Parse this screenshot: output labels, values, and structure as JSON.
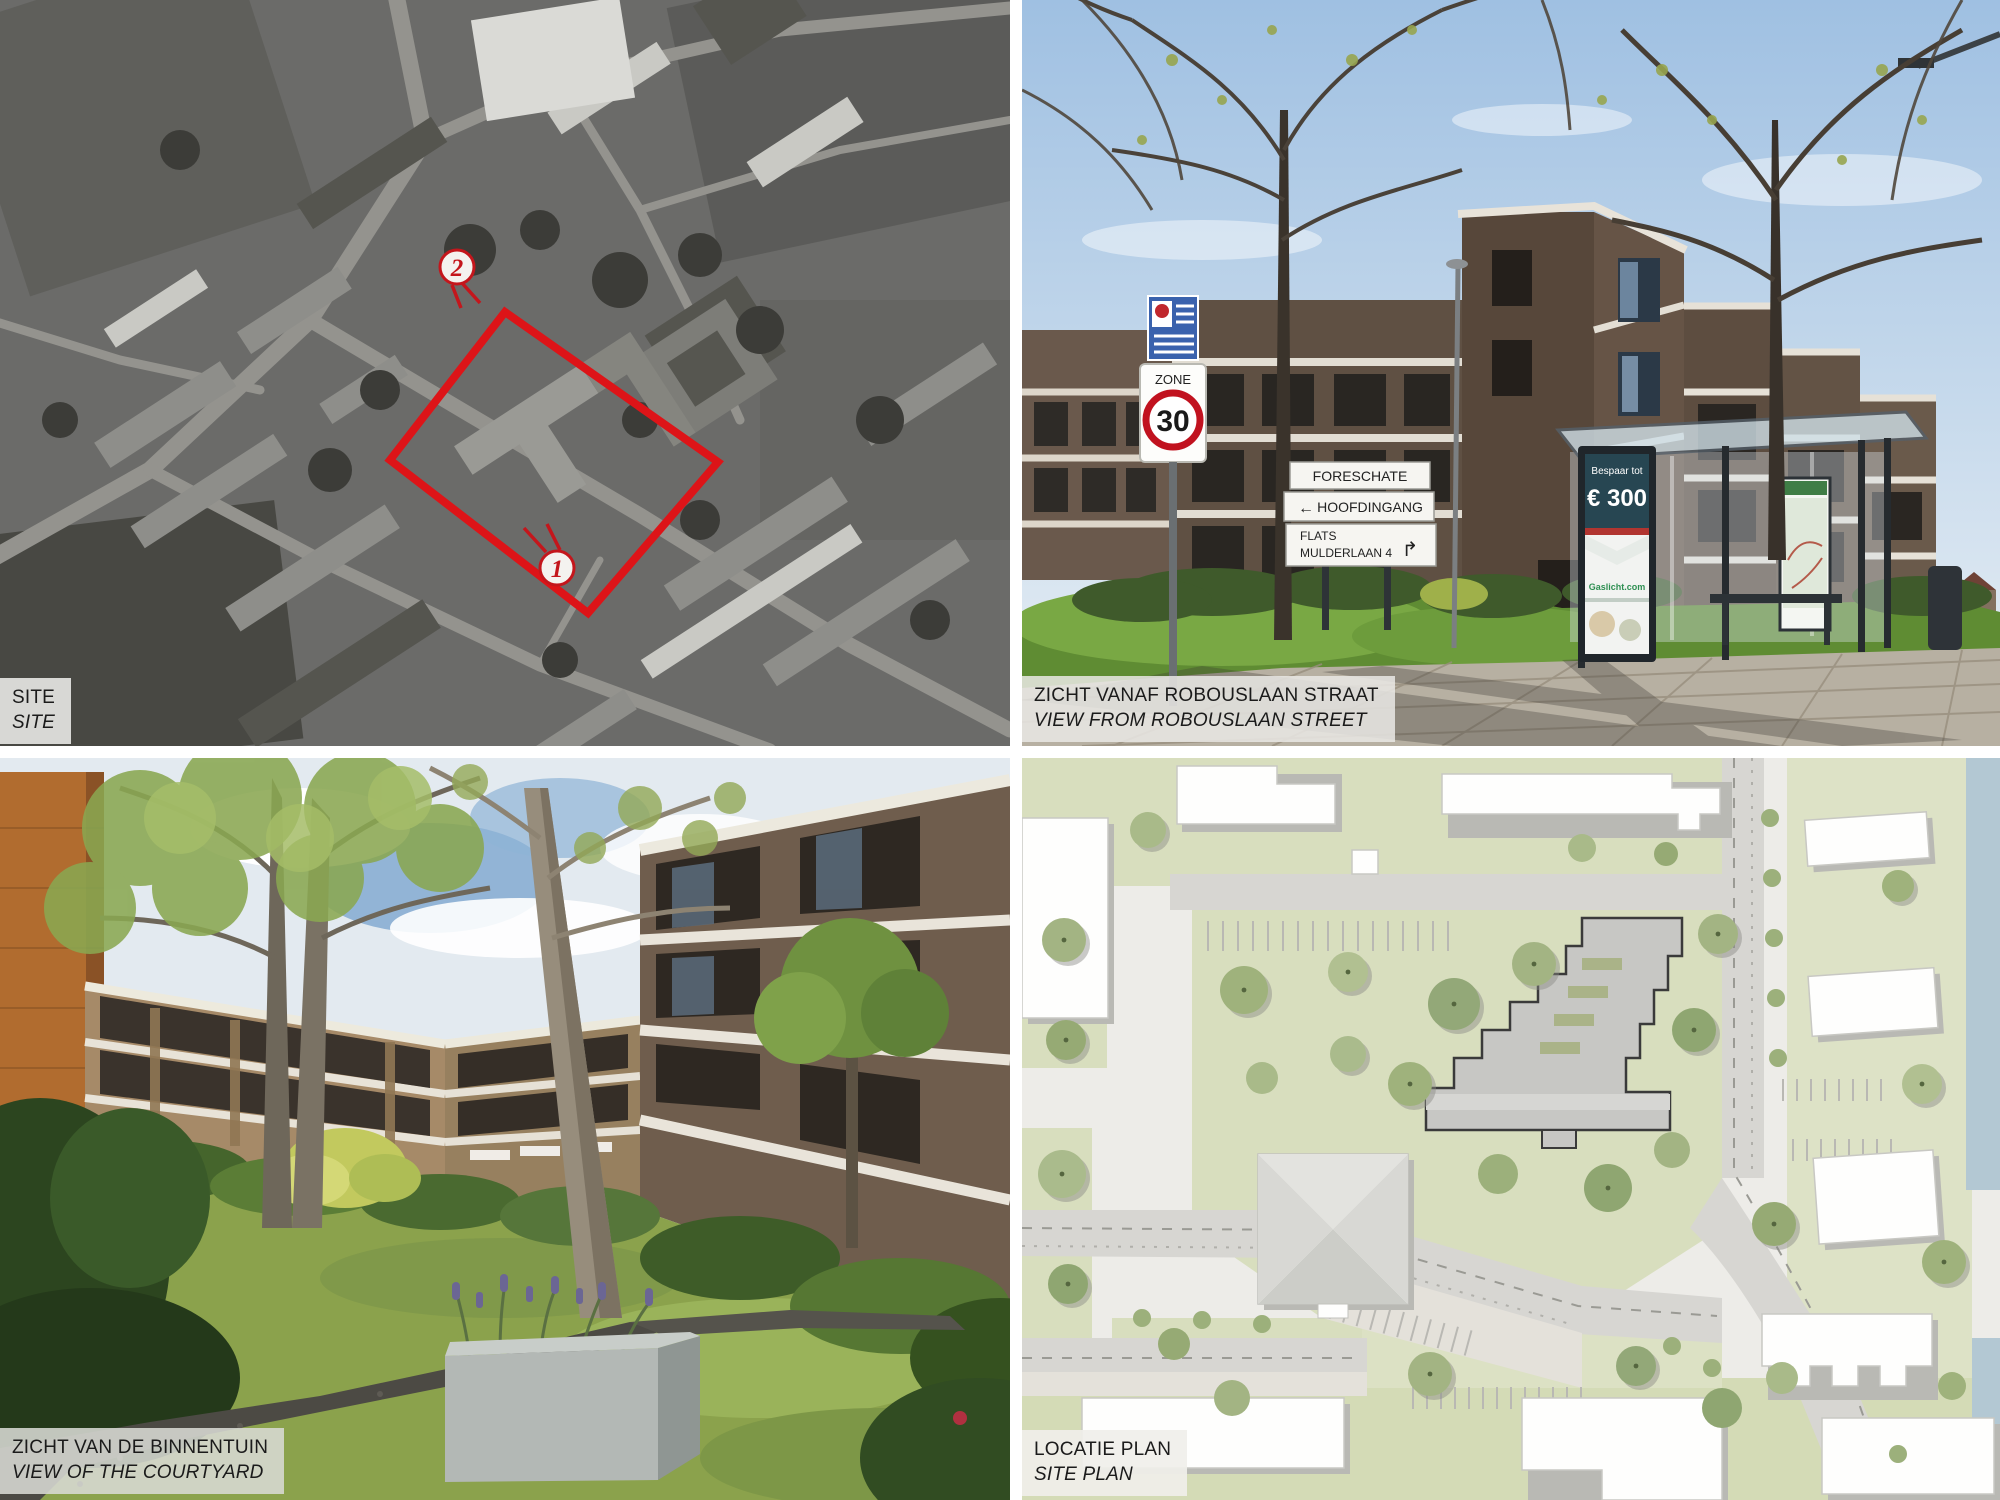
{
  "sheet": {
    "title_hidden": "",
    "accent_red": "#dd1418"
  },
  "panels": {
    "site_aerial": {
      "label_line1": "SITE",
      "label_line2": "SITE",
      "markers": {
        "m2": "2",
        "m1": "1"
      }
    },
    "street_view": {
      "label_line1": "ZICHT VANAF ROBOUSLAAN STRAAT",
      "label_line2": "VIEW FROM ROBOUSLAAN STREET",
      "zone_sign": {
        "zone": "ZONE",
        "speed": "30"
      },
      "direction_sign": {
        "board1": "FORESCHATE",
        "board2_arrow": "←",
        "board2": "HOOFDINGANG",
        "board3_line1": "FLATS",
        "board3_line2": "MULDERLAAN 4",
        "board3_arrow": "↱"
      },
      "bus_shelter_ad": {
        "line1": "Bespaar tot",
        "line2": "€ 300",
        "brand": "Gaslicht.com"
      }
    },
    "courtyard": {
      "label_line1": "ZICHT VAN DE BINNENTUIN",
      "label_line2": "VIEW OF THE COURTYARD"
    },
    "site_plan": {
      "label_line1": "LOCATIE PLAN",
      "label_line2": "SITE PLAN"
    }
  },
  "colors": {
    "site_boundary_red": "#dd1418",
    "plan_green": "#d8debe",
    "plan_water": "#b3c8d3",
    "plan_road": "#d7d6d2",
    "sky_blue": "#9fc0e2"
  }
}
